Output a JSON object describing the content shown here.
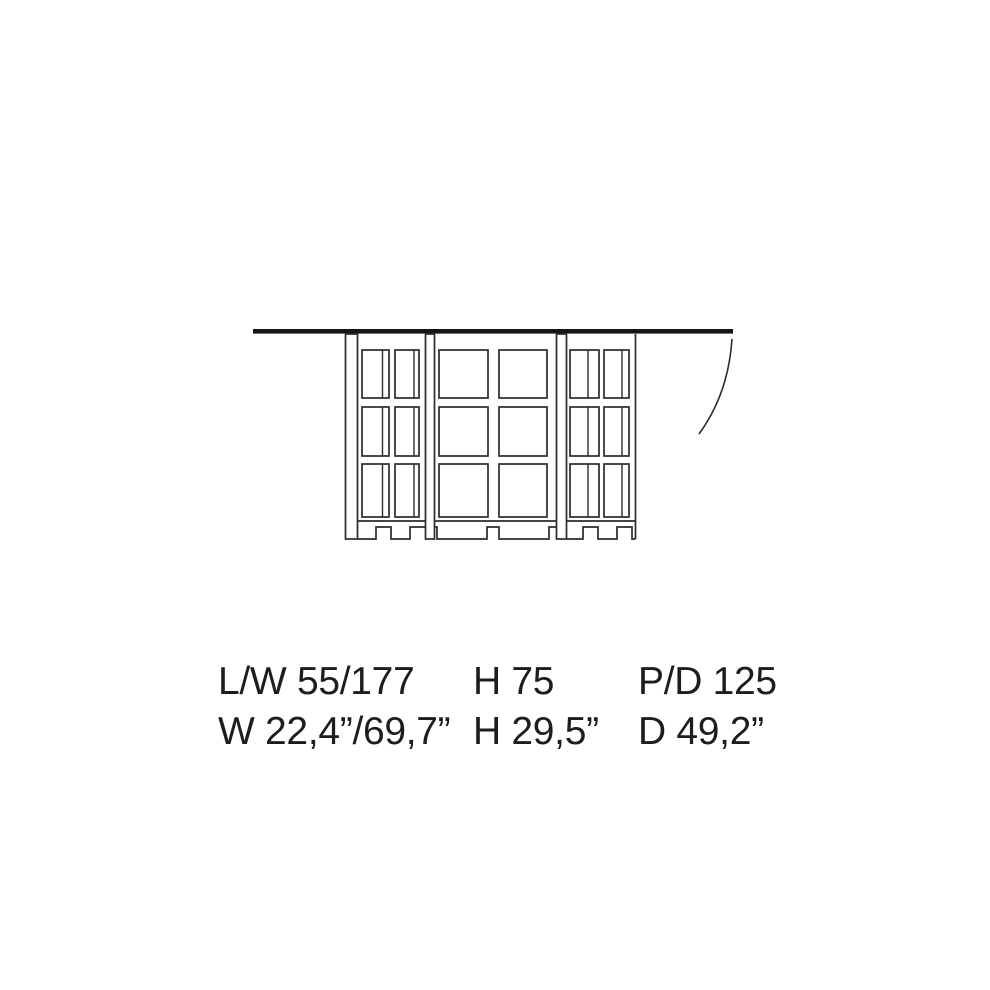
{
  "colors": {
    "background": "#ffffff",
    "line": "#2b2b2b",
    "tabletop": "#151515",
    "text": "#1d1d1d"
  },
  "drawing": {
    "subject": "table-front-elevation",
    "parts": [
      "tabletop-bar",
      "lattice-base",
      "leaf-swing-curve"
    ]
  },
  "dimensions": {
    "metric": {
      "length_width": "L/W 55/177",
      "height": "H 75",
      "depth": "P/D 125"
    },
    "imperial": {
      "width": "W 22,4”/69,7”",
      "height": "H 29,5”",
      "depth": "D 49,2”"
    }
  }
}
